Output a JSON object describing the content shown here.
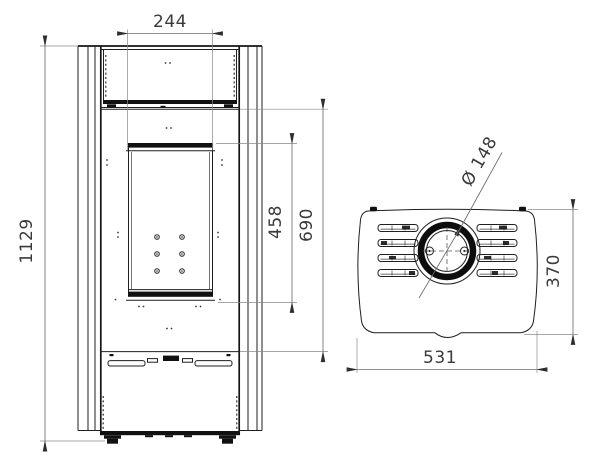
{
  "drawing": {
    "kind": "technical-dimension-drawing",
    "background": "#ffffff",
    "colors": {
      "object_line": "#1f1f1f",
      "dimension_line": "#6e6e6e",
      "dimension_text": "#3a3a3a"
    },
    "views": {
      "front": {
        "dimensions": {
          "glass_width": "244",
          "overall_height": "1129",
          "glass_height": "458",
          "door_height": "690"
        }
      },
      "top": {
        "dimensions": {
          "flue_diameter": "Ø 148",
          "depth": "370",
          "width": "531"
        }
      }
    }
  }
}
